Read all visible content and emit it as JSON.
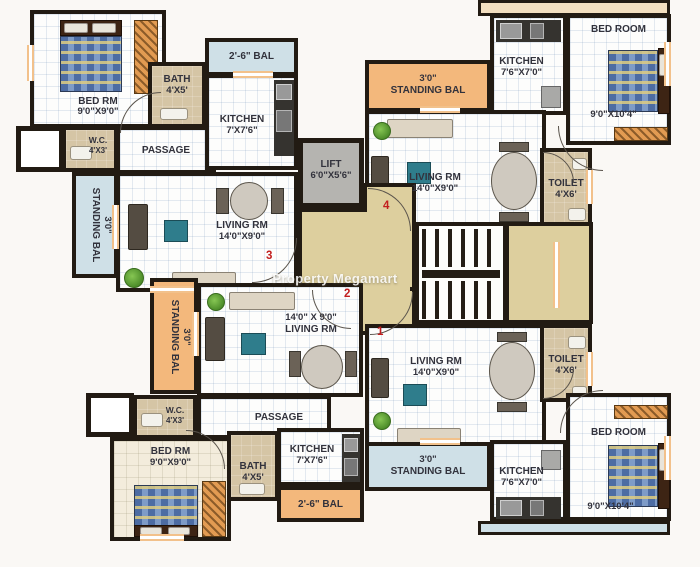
{
  "watermark": "Property Megamart",
  "core": {
    "lift": {
      "name": "LIFT",
      "dims": "6'0\"X5'6\""
    }
  },
  "flats": {
    "f3": {
      "number": "3",
      "bedroom": {
        "name": "BED RM",
        "dims": "9'0\"X9'0\""
      },
      "wc": {
        "name": "W.C.",
        "dims": "4'X3'"
      },
      "bath": {
        "name": "BATH",
        "dims": "4'X5'"
      },
      "passage": {
        "name": "PASSAGE"
      },
      "bal": {
        "name": "2'-6\" BAL"
      },
      "kitchen": {
        "name": "KITCHEN",
        "dims": "7'X7'6\""
      },
      "living": {
        "name": "LIVING RM",
        "dims": "14'0\"X9'0\""
      },
      "standing_bal": {
        "dims": "3'0\"",
        "name": "STANDING BAL"
      }
    },
    "f4": {
      "number": "4",
      "standing_bal": {
        "dims": "3'0\"",
        "name": "STANDING BAL"
      },
      "kitchen": {
        "name": "KITCHEN",
        "dims": "7'6\"X7'0\""
      },
      "bedroom": {
        "name": "BED ROOM",
        "dims": "9'0\"X10'4\""
      },
      "living": {
        "name": "LIVING RM",
        "dims": "14'0\"X9'0\""
      },
      "toilet": {
        "name": "TOILET",
        "dims": "4'X6'"
      }
    },
    "f2": {
      "number": "2",
      "living": {
        "dims": "14'0\" X 9'0\"",
        "name": "LIVING RM"
      },
      "passage": {
        "name": "PASSAGE"
      },
      "wc": {
        "name": "W.C.",
        "dims": "4'X3'"
      },
      "bedroom": {
        "name": "BED RM",
        "dims": "9'0\"X9'0\""
      },
      "bath": {
        "name": "BATH",
        "dims": "4'X5'"
      },
      "kitchen": {
        "name": "KITCHEN",
        "dims": "7'X7'6\""
      },
      "bal": {
        "name": "2'-6\" BAL"
      },
      "standing_bal": {
        "dims": "3'0\"",
        "name": "STANDING BAL"
      }
    },
    "f1": {
      "number": "1",
      "living": {
        "name": "LIVING RM",
        "dims": "14'0\"X9'0\""
      },
      "toilet": {
        "name": "TOILET",
        "dims": "4'X6'"
      },
      "bedroom": {
        "name": "BED ROOM",
        "dims": "9'0\"X10'4\""
      },
      "kitchen": {
        "name": "KITCHEN",
        "dims": "7'6\"X7'0\""
      },
      "standing_bal": {
        "dims": "3'0\"",
        "name": "STANDING BAL"
      }
    }
  },
  "colors": {
    "wall": "#221b13",
    "lobby": "#ddcf9e",
    "balcony_blue": "#cfe0e7",
    "balcony_orange": "#f3b87c",
    "lift_gray": "#b5b4b0",
    "bath_floor": "#d5c5a5",
    "unit_number_red": "#c21d1d"
  }
}
